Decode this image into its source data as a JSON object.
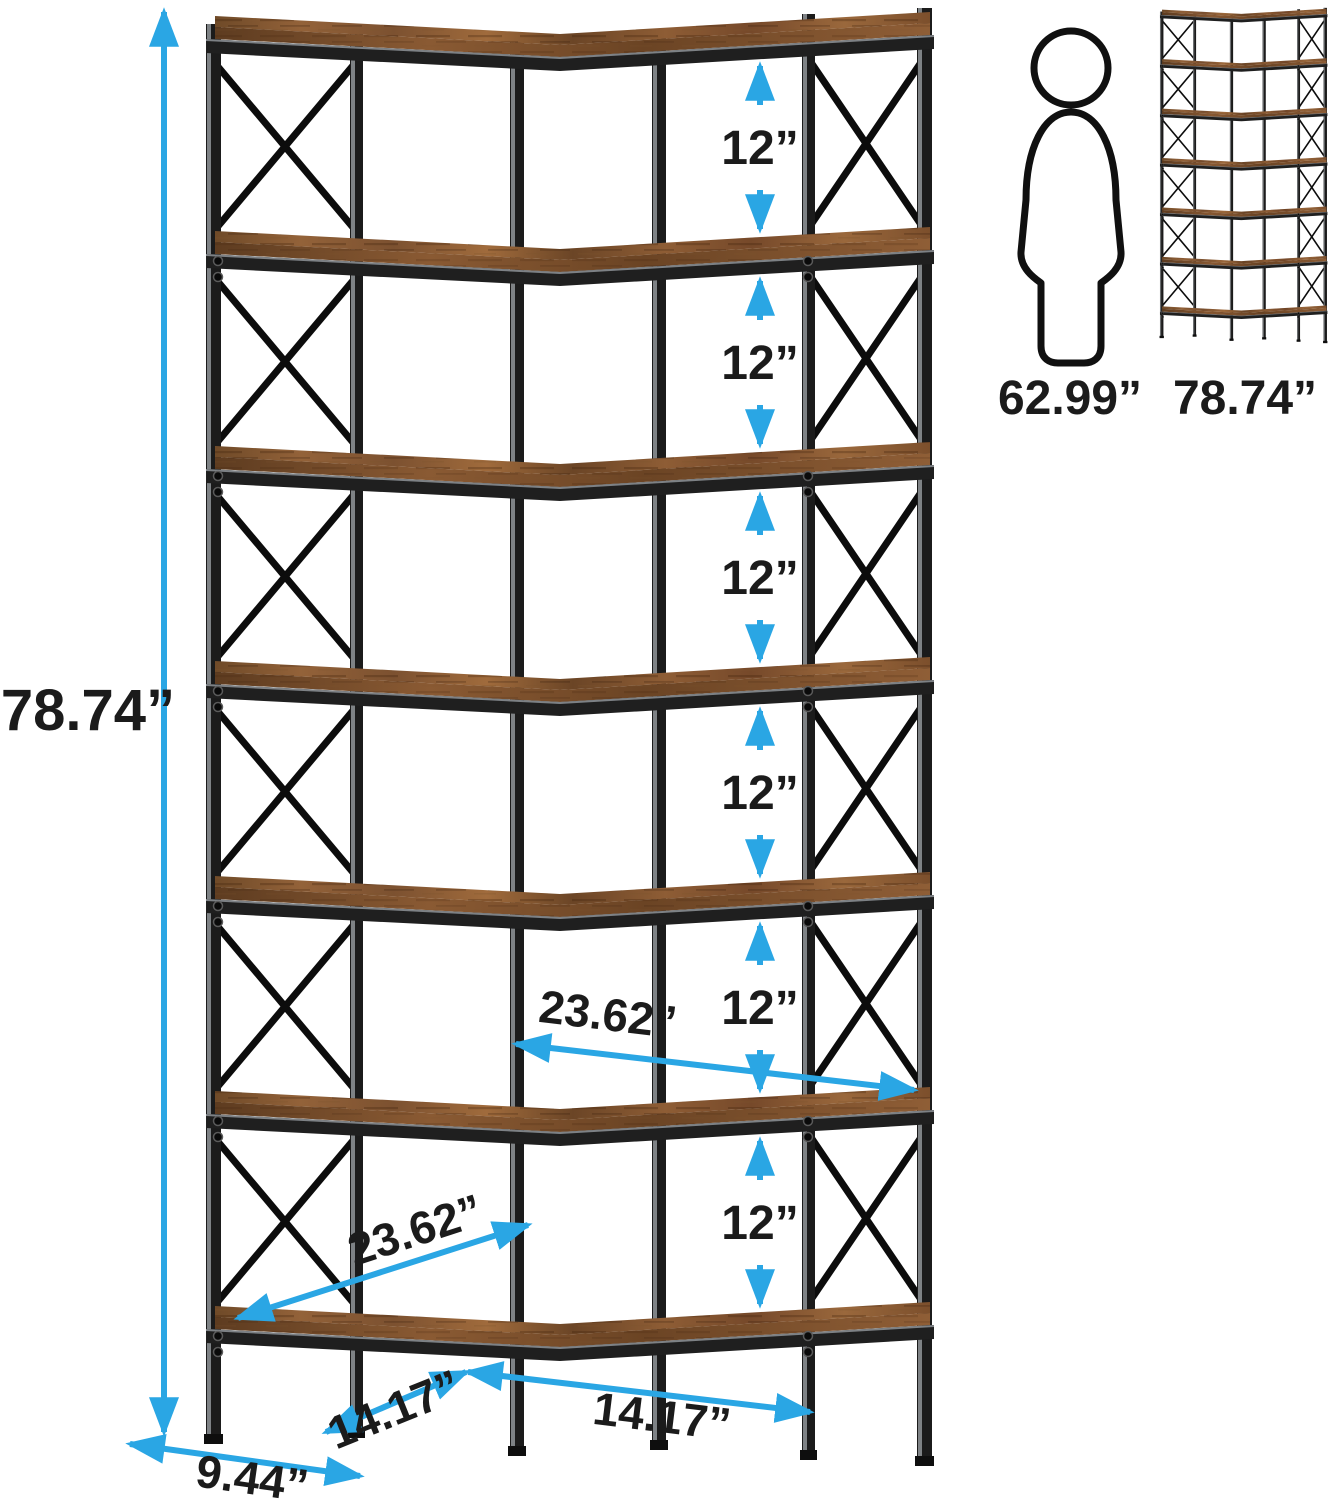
{
  "page": {
    "background": "#ffffff"
  },
  "colors": {
    "dimension_blue": "#2aa6e4",
    "label_black": "#1b1b1b",
    "wood_brown": "#8a5a33",
    "frame_black": "#1a1a1a"
  },
  "main_diagram": {
    "description": "7-tier corner bookshelf with rustic wood shelves and black metal X-brace frame",
    "total_height": {
      "label": "78.74”"
    },
    "tier_gaps": [
      {
        "label": "12”"
      },
      {
        "label": "12”"
      },
      {
        "label": "12”"
      },
      {
        "label": "12”"
      },
      {
        "label": "12”"
      },
      {
        "label": "12”"
      }
    ],
    "upper_width": {
      "label": "23.62”"
    },
    "lower_width": {
      "label": "23.62”"
    },
    "bottom_left_width": {
      "label": "14.17”"
    },
    "bottom_right_width": {
      "label": "14.17”"
    },
    "side_depth": {
      "label": "9.44”"
    }
  },
  "size_reference": {
    "person_height_label": "62.99”",
    "bookshelf_height_label": "78.74”"
  }
}
